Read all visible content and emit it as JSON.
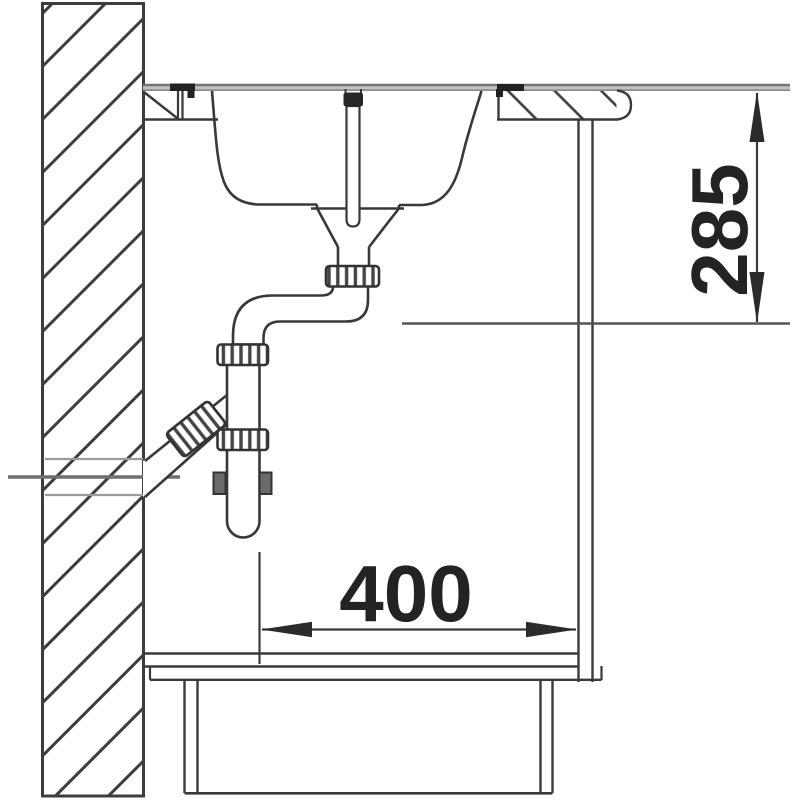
{
  "diagram": {
    "type": "technical_line_drawing",
    "subject": "Kitchen sink with bottle trap installation, side cross-section in base cabinet against wall",
    "elements": [
      "hatched-wall-section",
      "worktop-with-sink-cutout",
      "inset-sink-bowl",
      "overflow-standpipe",
      "drain-funnel",
      "s-bend-outlet-pipe",
      "bottle-trap",
      "angled-wall-outlet-pipe",
      "base-cabinet",
      "recessed-plinth"
    ],
    "dimensions": {
      "vertical": {
        "value": "285",
        "orientation": "vertical"
      },
      "horizontal": {
        "value": "400",
        "orientation": "horizontal"
      }
    },
    "colors": {
      "line": "#3a3a3a",
      "gray_line": "#8f8f8f",
      "worktop_band": "#c2c2c2",
      "dim_text": "#232323",
      "background": "#ffffff"
    }
  }
}
